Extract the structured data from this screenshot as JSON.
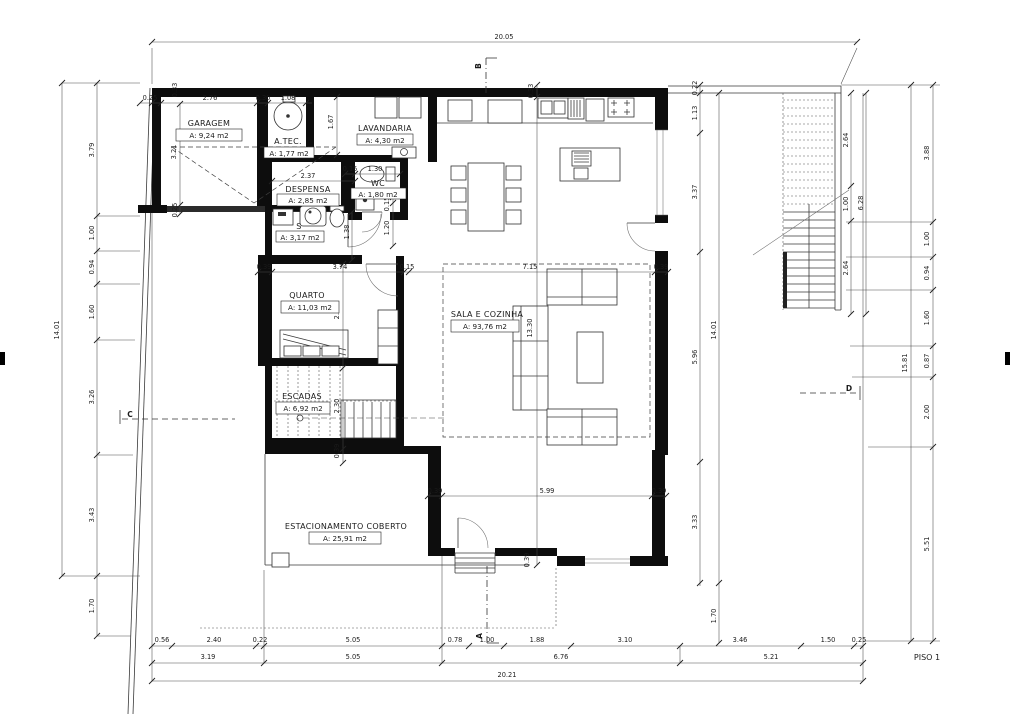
{
  "title": "PISO 1",
  "rooms": {
    "garagem": {
      "name": "GARAGEM",
      "area": "A: 9,24 m2"
    },
    "atec": {
      "name": "A.TEC.",
      "area": "A: 1,77 m2"
    },
    "lavandaria": {
      "name": "LAVANDARIA",
      "area": "A: 4,30 m2"
    },
    "despensa": {
      "name": "DESPENSA",
      "area": "A: 2,85 m2"
    },
    "wc": {
      "name": "WC",
      "area": "A: 1,80 m2"
    },
    "s": {
      "name": "S",
      "area": "A: 3,17 m2"
    },
    "quarto": {
      "name": "QUARTO",
      "area": "A: 11,03 m2"
    },
    "escadas": {
      "name": "ESCADAS",
      "area": "A: 6,92 m2"
    },
    "sala": {
      "name": "SALA E COZINHA",
      "area": "A: 93,76 m2"
    },
    "estacionamento": {
      "name": "ESTACIONAMENTO COBERTO",
      "area": "A: 25,91 m2"
    }
  },
  "sections": {
    "a": "A",
    "b": "B",
    "c": "C",
    "d": "D"
  },
  "dims": {
    "top_overall": "20.05",
    "top_row": [
      "0.25",
      "2.76",
      "0.30",
      "1.08"
    ],
    "wall_thk": [
      "0.33",
      "0.33"
    ],
    "left_overall": "14.01",
    "left_row": [
      "3.79",
      "1.00",
      "0.94",
      "1.60",
      "3.26",
      "3.43",
      "1.70"
    ],
    "right_overall": "15.81",
    "right_row": [
      "3.88",
      "1.00",
      "0.94",
      "1.60",
      "0.87",
      "2.00",
      "5.51"
    ],
    "inner_overall": "14.01",
    "inner_row": [
      "0.22",
      "1.13",
      "3.37",
      "5.96",
      "3.33",
      "1.70"
    ],
    "stair_overall": "6.28",
    "stair_row": [
      "2.64",
      "1.00",
      "2.64"
    ],
    "bottom_row1": [
      "0.56",
      "2.40",
      "0.22",
      "5.05",
      "0.78",
      "1.00",
      "1.88",
      "3.10",
      "3.46",
      "1.50",
      "0.25"
    ],
    "bottom_row2": [
      "3.19",
      "5.05",
      "6.76",
      "5.21"
    ],
    "bottom_overall": "20.21",
    "mid_row": [
      "0.39",
      "3.74",
      "0.15",
      "7.15",
      "0.39"
    ],
    "lower_row": [
      "0.39",
      "5.99",
      "0.39"
    ],
    "garagem": [
      "3.21",
      "0.25"
    ],
    "lav_depth": "1.67",
    "desp_w": "2.37",
    "wc_row": [
      "0.15",
      "1.30"
    ],
    "wc_col": [
      "0.15",
      "1.20"
    ],
    "s_h": "1.38",
    "quarto_h": "2.96",
    "esc": [
      "2.30",
      "0.39"
    ],
    "sala_h": "13.30",
    "entry": "0.39"
  }
}
